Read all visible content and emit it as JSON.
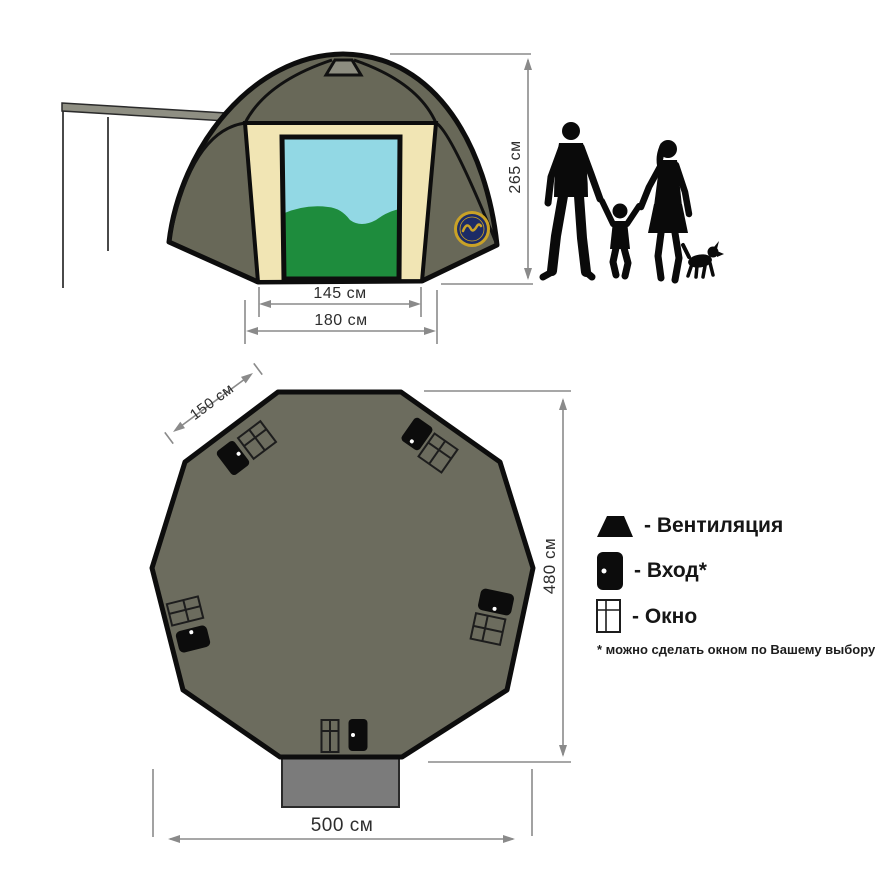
{
  "front_view": {
    "height_label": "265 см",
    "door_width_label": "145 см",
    "panel_width_label": "180 см"
  },
  "plan_view": {
    "side_label": "150 см",
    "depth_label": "480 см",
    "width_label": "500 см"
  },
  "legend": {
    "items": [
      {
        "icon": "ventilation-icon",
        "label": "- Вентиляция"
      },
      {
        "icon": "entrance-door-icon",
        "label": "- Вход*"
      },
      {
        "icon": "window-icon",
        "label": "- Окно"
      }
    ],
    "note": "* можно сделать окном по Вашему выбору"
  },
  "colors": {
    "tent_body": "#686858",
    "plan_body": "#6C6C5E",
    "front_panel": "#F1E5B4",
    "door_sky": "#92D8E4",
    "door_hills": "#1E8C3D",
    "roof_vent": "#8D8D80",
    "vestibule": "#7B7B7B",
    "logo_navy": "#1C2B66",
    "logo_gold": "#C9A227",
    "dimension_line": "#8a8a8a",
    "outline": "#0d0d0d"
  }
}
